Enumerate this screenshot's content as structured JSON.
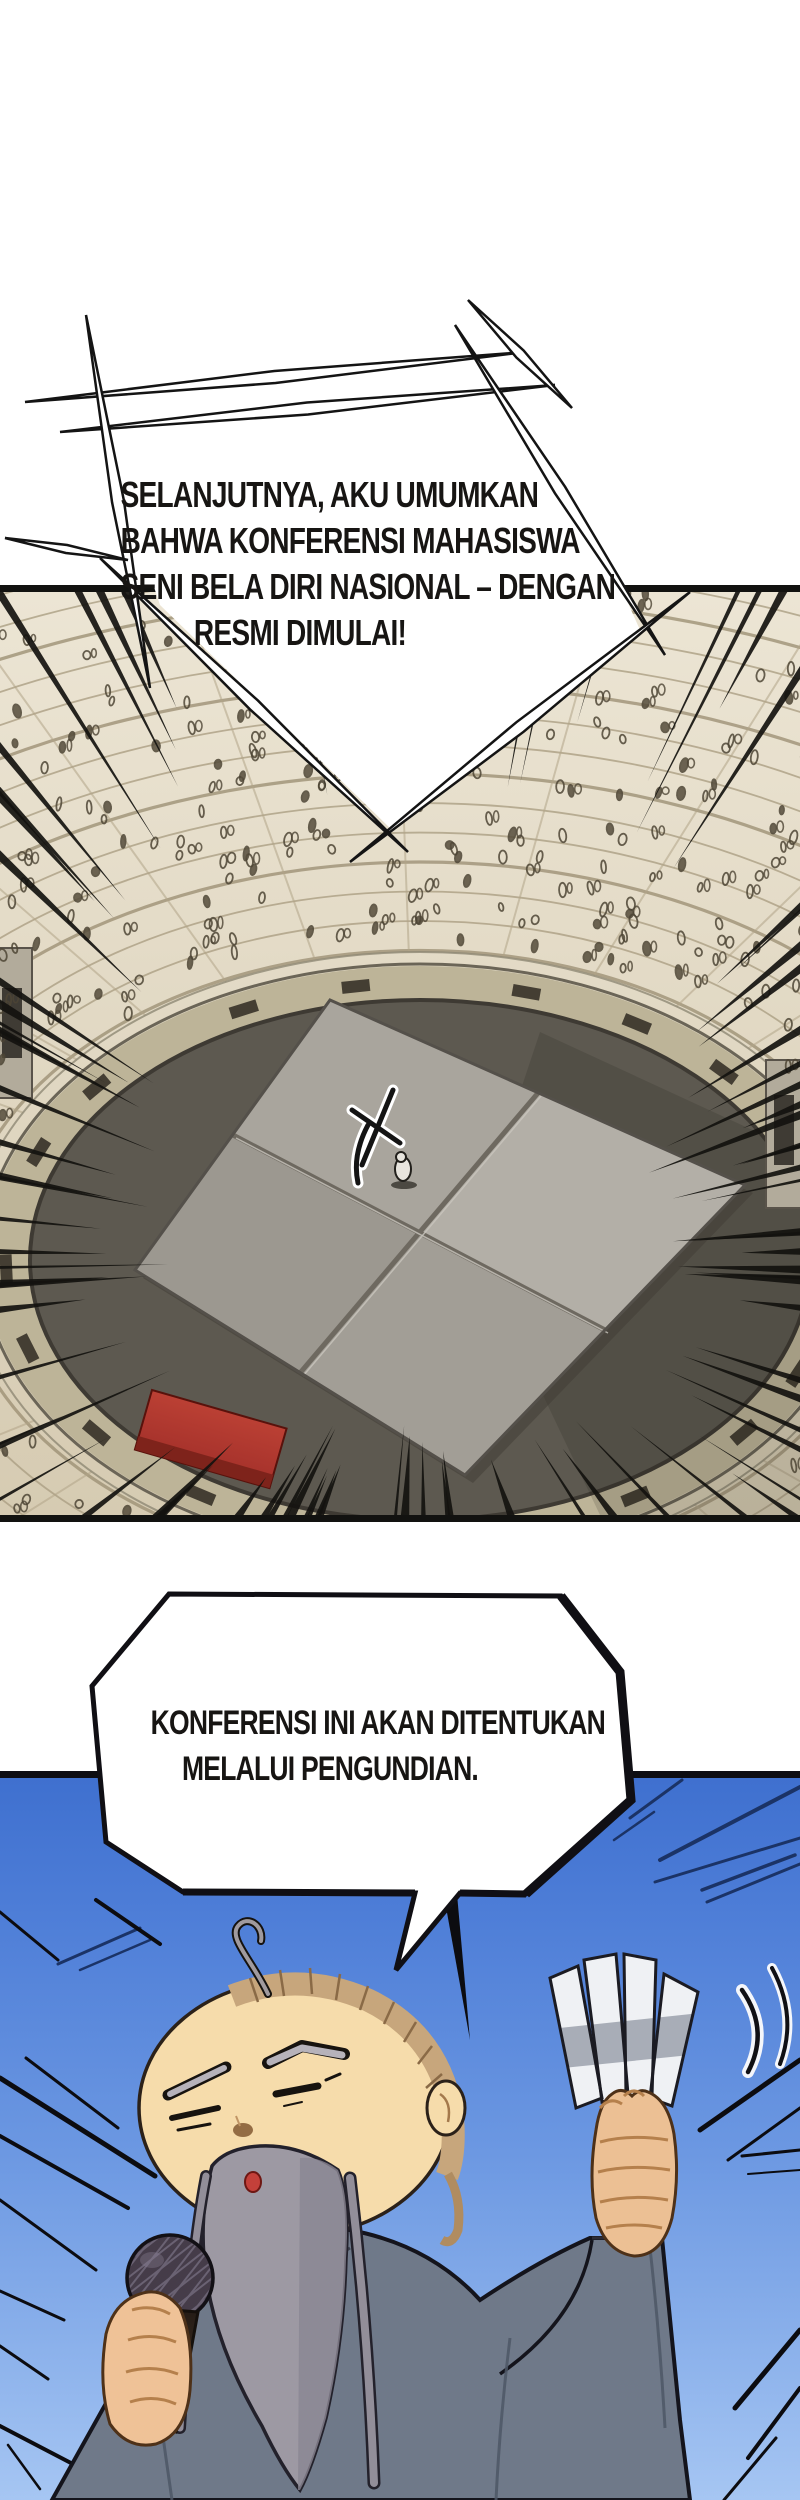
{
  "page": {
    "type": "comic-page",
    "language": "Indonesian"
  },
  "bubbles": {
    "announcement": {
      "shape": "spiky-burst",
      "lines": [
        "SELANJUTNYA, AKU UMUMKAN",
        "BAHWA KONFERENSI MAHASISWA",
        "SENI BELA DIRI NASIONAL – DENGAN",
        "RESMI DIMULAI!"
      ]
    },
    "lottery": {
      "shape": "octagon",
      "lines": [
        "KONFERENSI INI AKAN DITENTUKAN",
        "MELALUI PENGUNDIAN."
      ]
    }
  },
  "panels": [
    {
      "id": "arena",
      "description": "aerial view of tournament arena: crowded circular stands, dark floor, large four-section square platform with tiny announcer figure, red banner"
    },
    {
      "id": "announcer",
      "description": "elderly bald announcer with long gray beard, gray robe, microphone in right hand and fanned lottery slips in left hand, blue sky with speed lines"
    }
  ],
  "colors": {
    "stands": "#e6dfcd",
    "stands_row_line": "#9d9176",
    "walkway": "#bdb498",
    "floor": "#5d5950",
    "platform": "#a9a59d",
    "platform_seam": "#6e6960",
    "banner_red": "#b53a30",
    "sky_top": "#3f70cf",
    "sky_bottom": "#a6c6f3",
    "streak_navy": "#1b3366",
    "robe": "#6f7989",
    "skin": "#f6dcab",
    "beard": "#9d99a3",
    "hair": "#c7a67c",
    "slip_white": "#eff1f4",
    "mic_dark": "#453c49",
    "ink": "#141414"
  },
  "decor": {
    "seed": 7,
    "crowd_count": 250,
    "focus_spikes": 84,
    "rings": 16,
    "spokes": 30,
    "benches": 18
  }
}
